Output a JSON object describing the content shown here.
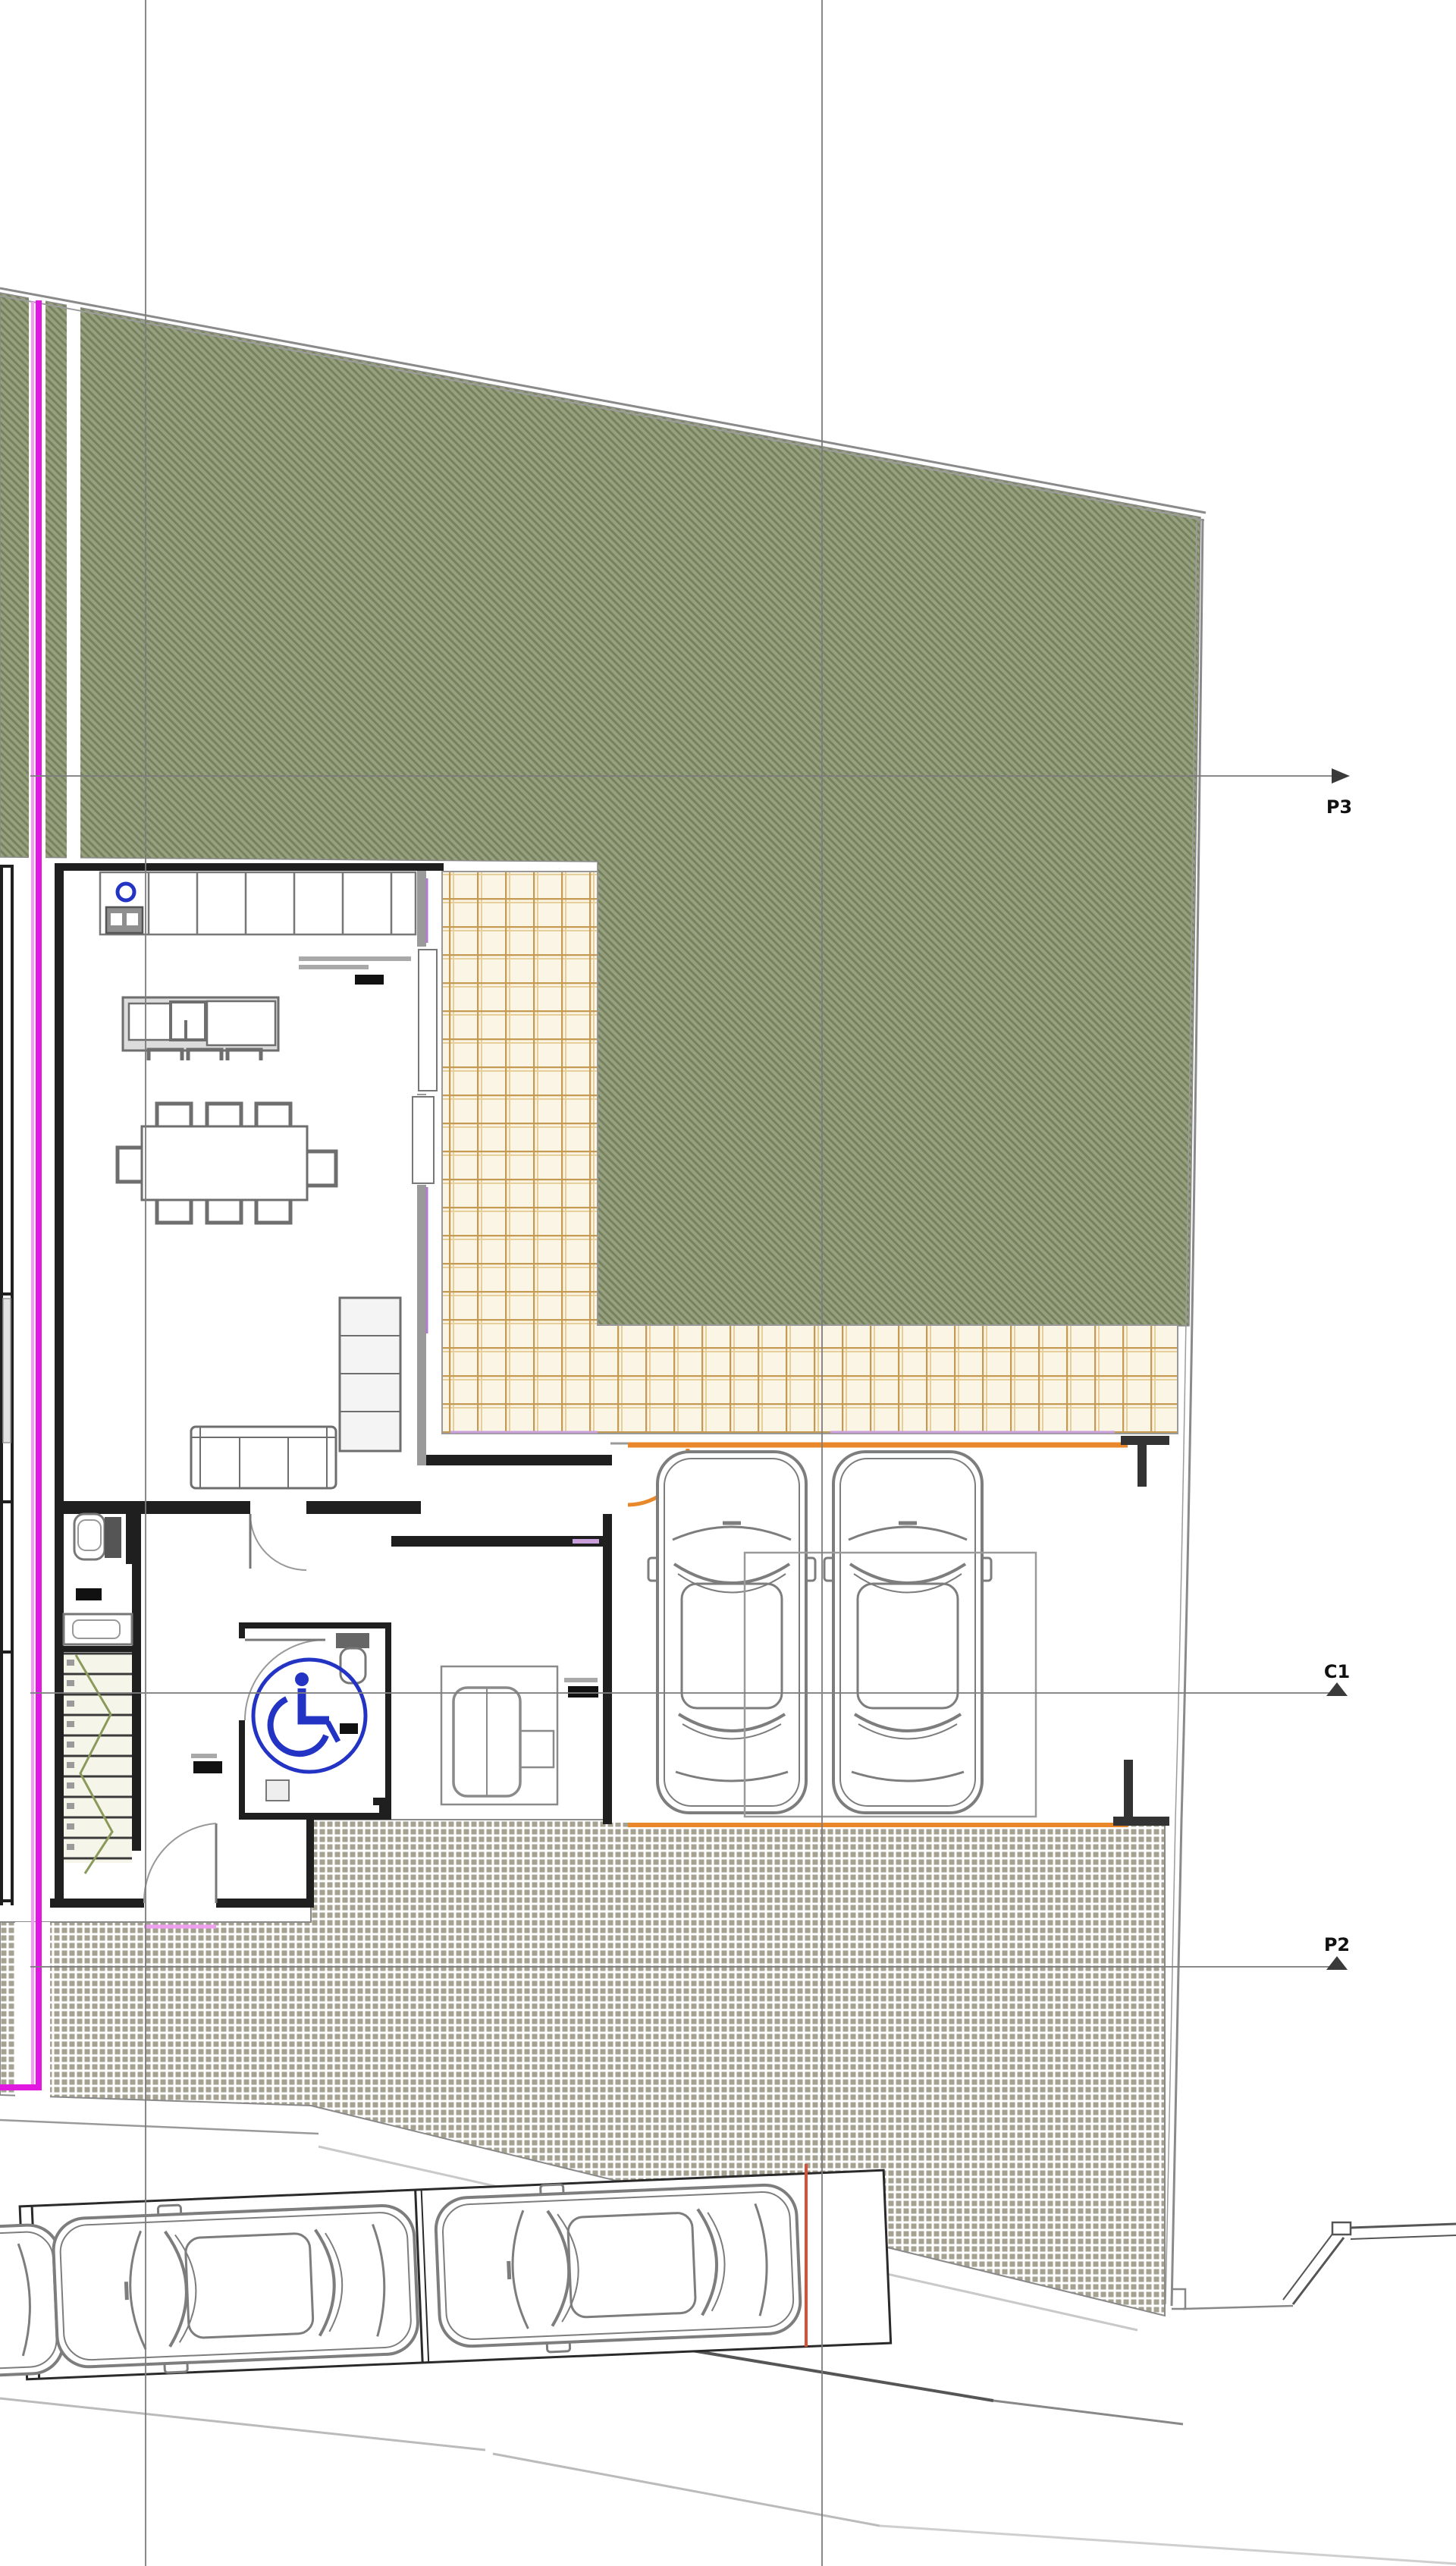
{
  "document": {
    "kind": "architectural-site-plan",
    "view": "ground floor plan with site, carport and street parking",
    "sheet_background": "#ffffff"
  },
  "axis_markers": [
    {
      "label": "P3",
      "orientation": "horizontal"
    },
    {
      "label": "C1",
      "orientation": "horizontal"
    },
    {
      "label": "P2",
      "orientation": "horizontal"
    }
  ],
  "colors": {
    "garden_hatch_light": "#97a07f",
    "garden_hatch_dark": "#76825e",
    "boundary_gray": "#8a8a8a",
    "grid_line_gray": "#7d7d7d",
    "property_line_magenta": "#e018e0",
    "property_line_magenta_light": "#f49bf4",
    "terrace_tile_bg": "#fbf5e6",
    "terrace_tile_line": "#c59a52",
    "paving_square_gray": "#a6a292",
    "accent_orange": "#e8882a",
    "curb_line_red": "#d85038",
    "accessibility_blue": "#2334c4",
    "threshold_lilac": "#c9a0dc",
    "wall_black": "#1f1f1f",
    "furniture_gray": "#6e6e6e"
  },
  "elements": {
    "carport_cars": 2,
    "street_parked_cars": 3,
    "dining_chairs": 8,
    "kitchen_island_stools": 3,
    "stair_treads": 11,
    "accessibility_symbol": "wheelchair",
    "kitchen_counter_segments": 6,
    "cooktop_burners": 2,
    "illegible_small_labels": 5
  }
}
